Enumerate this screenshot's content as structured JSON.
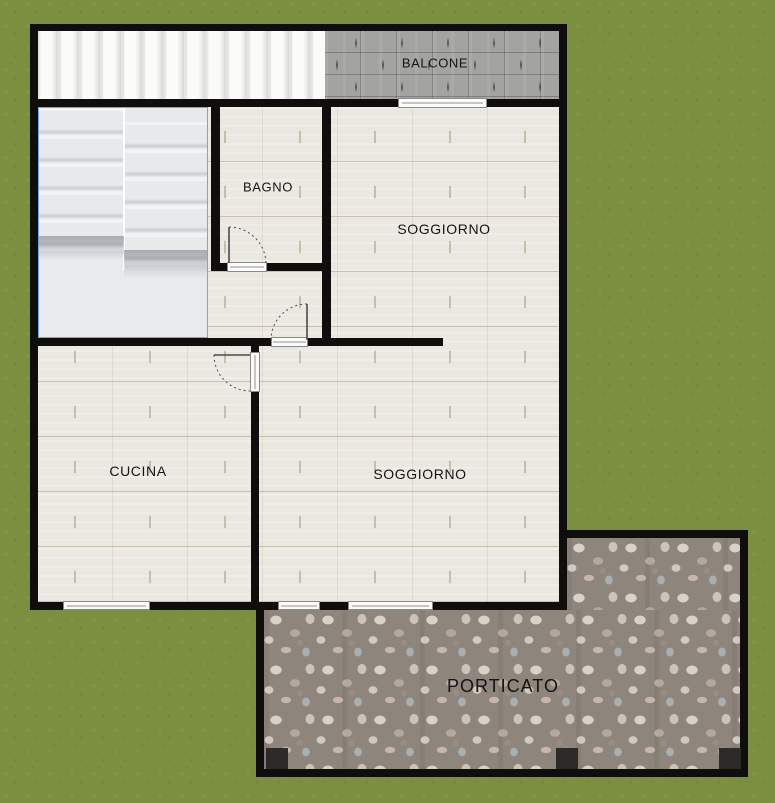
{
  "title": "floor-plan",
  "rooms": [
    {
      "id": "balcone",
      "label": "BALCONE"
    },
    {
      "id": "bagno",
      "label": "BAGNO"
    },
    {
      "id": "soggiorno-top",
      "label": "SOGGIORNO"
    },
    {
      "id": "cucina",
      "label": "CUCINA"
    },
    {
      "id": "soggiorno-bottom",
      "label": "SOGGIORNO"
    },
    {
      "id": "porticato",
      "label": "PORTICATO"
    }
  ],
  "colors": {
    "grass": "#7c8e40",
    "wall": "#0f0e0c",
    "floor": "#ebe8e1",
    "stairs": "#e8eaec",
    "stairs_border": "#74a8d8",
    "planks": "#f3f3f2",
    "balcone": "#a3a4a0",
    "porticato": "#8e857c",
    "pillar": "#2d2b27",
    "label": "#141414",
    "threshold_border": "#8a8a8a"
  }
}
